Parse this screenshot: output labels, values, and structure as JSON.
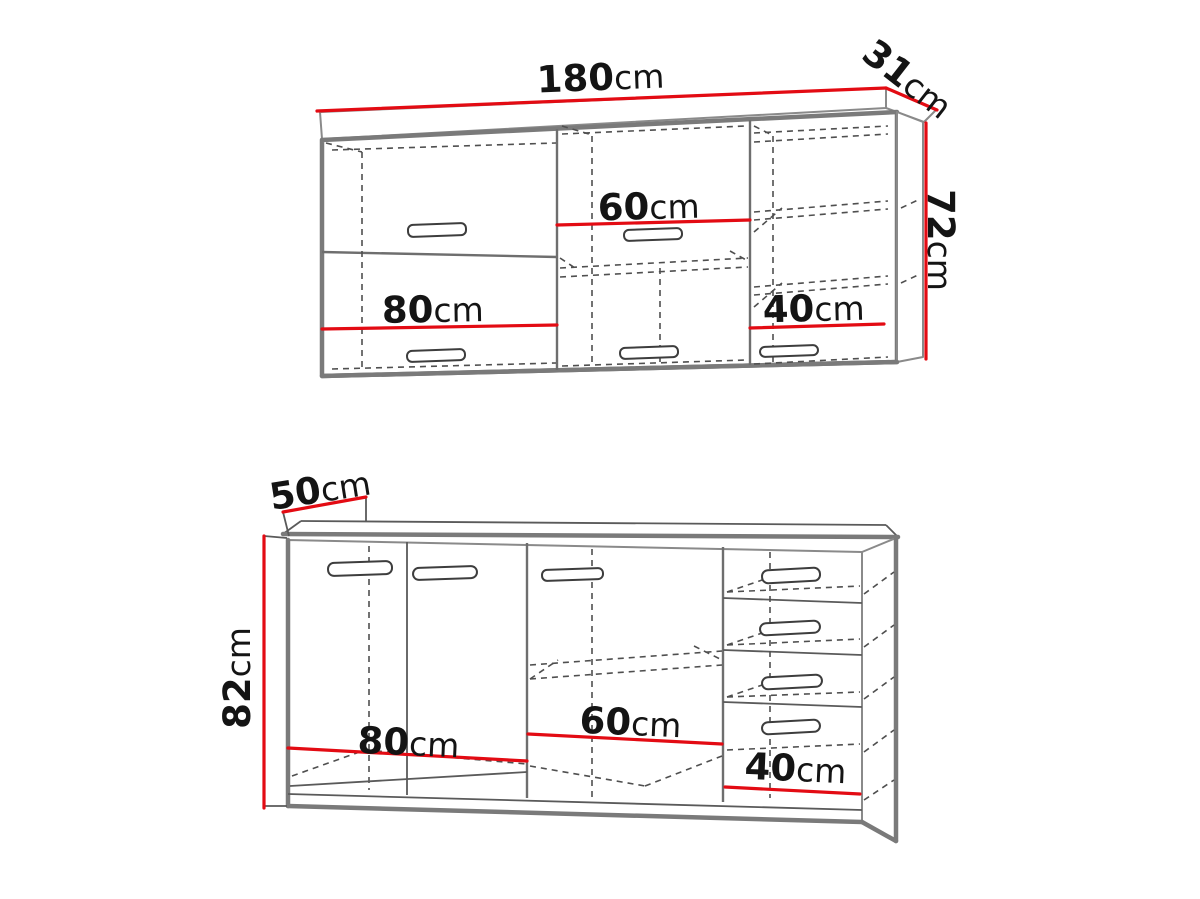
{
  "diagram": {
    "background": "#ffffff",
    "accent_red": "#e30b13",
    "outline_gray": "#7a7a7a",
    "text_color": "#141414",
    "unit": "cm"
  },
  "wall_cabinet": {
    "width_label": {
      "value": "180",
      "unit": "cm"
    },
    "depth_label": {
      "value": "31",
      "unit": "cm"
    },
    "height_label": {
      "value": "72",
      "unit": "cm"
    },
    "section_left_label": {
      "value": "80",
      "unit": "cm"
    },
    "section_middle_label": {
      "value": "60",
      "unit": "cm"
    },
    "section_right_label": {
      "value": "40",
      "unit": "cm"
    }
  },
  "base_cabinet": {
    "depth_label": {
      "value": "50",
      "unit": "cm"
    },
    "height_label": {
      "value": "82",
      "unit": "cm"
    },
    "section_left_label": {
      "value": "80",
      "unit": "cm"
    },
    "section_middle_label": {
      "value": "60",
      "unit": "cm"
    },
    "section_right_label": {
      "value": "40",
      "unit": "cm"
    }
  }
}
